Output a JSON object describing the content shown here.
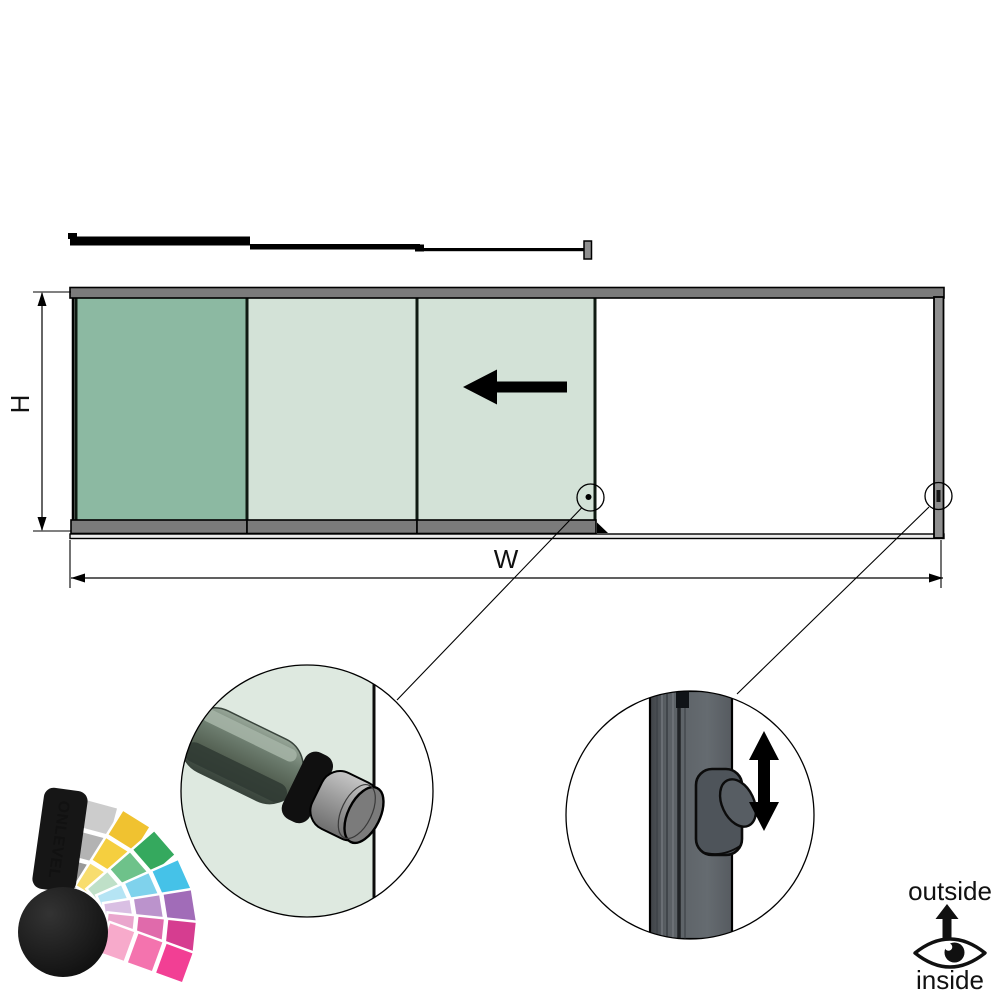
{
  "drawing": {
    "type": "sliding-glass-panel-system-elevation",
    "height_dimension_label": "H",
    "width_dimension_label": "W",
    "panel_count_glazed": 3,
    "slide_direction": "left",
    "details": [
      "cylindrical-pull-knob-on-glass-edge",
      "sliding-latch-lever-on-frame-post"
    ]
  },
  "orientation_legend": {
    "outside_label": "outside",
    "inside_label": "inside"
  },
  "brand": {
    "logo_text": "ONLEVEL"
  },
  "colors": {
    "panel_active_green": "#8cb9a2",
    "panel_light_green": "#d3e2d7",
    "frame_rail_gray": "#7b7b7b",
    "frame_post_gray": "#8f8f8f",
    "detail_glass_green": "#dee9e0",
    "latch_post_gray": "#565b60",
    "knob_body_green_gray": "#5b6b5e",
    "knob_cap_gray": "#9d9d9d",
    "fan_gray": "#b0b0b0",
    "fan_yellow": "#f5cf3f",
    "fan_green": "#6ec28a",
    "fan_cyan": "#7fd2ec",
    "fan_purple": "#bb93cc",
    "fan_magenta": "#e06aab",
    "fan_pink": "#f23f94",
    "ink": "#000000"
  }
}
